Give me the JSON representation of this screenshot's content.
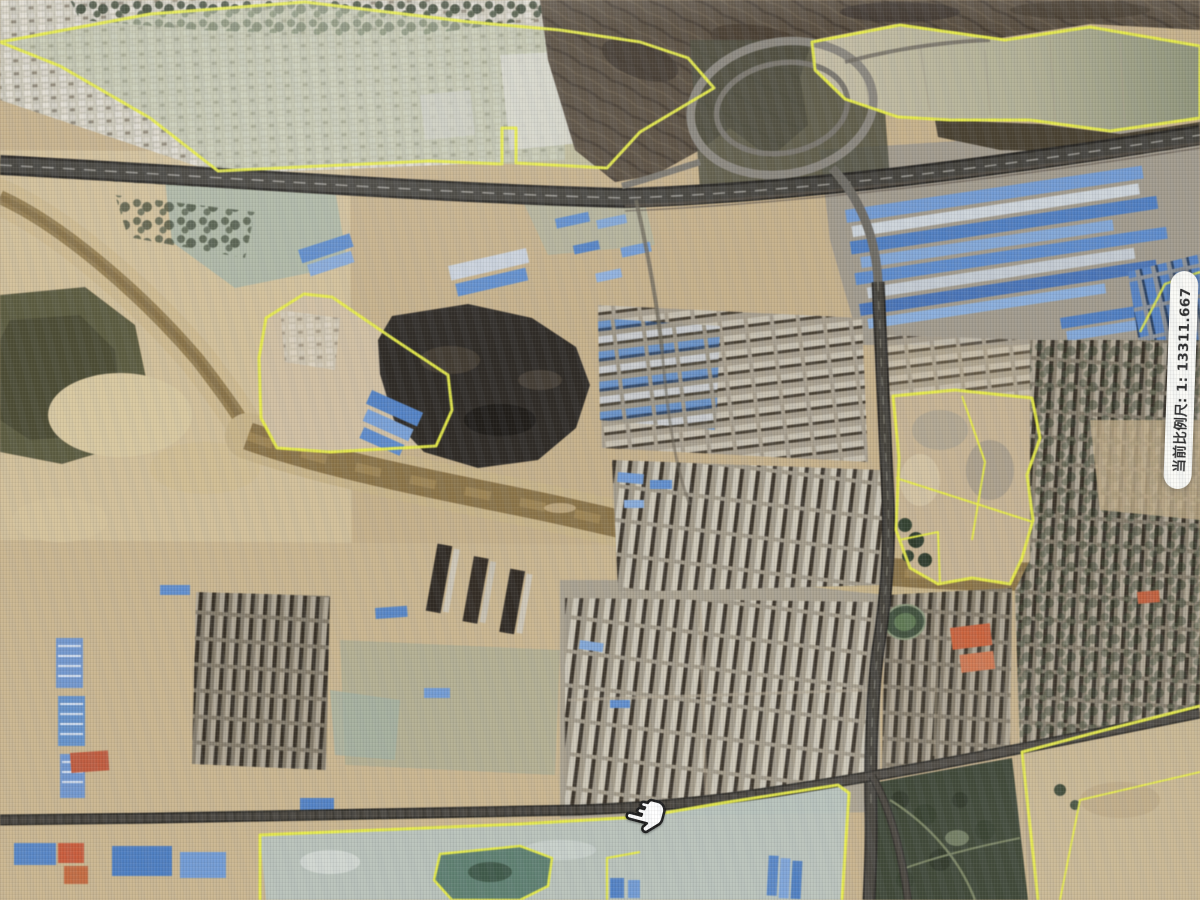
{
  "viewer": {
    "type": "satellite-map-viewer",
    "language": "zh-CN"
  },
  "scale_indicator": {
    "text": "当前比例尺: 1: 13311.667",
    "scale_value": "1:13311.667",
    "background_color": "#fafaf6",
    "text_color": "#2b2b2b"
  },
  "cursor": {
    "icon": "hand-grab-cursor",
    "x": 630,
    "y": 800
  },
  "map_overlay": {
    "parcel_boundary_color": "#e9ee3b"
  },
  "imagery_colors": {
    "bare_earth": "#c7b087",
    "river_water": "#8c7344",
    "highway_asphalt": "#44423c",
    "blue_roofs": "#5285cc",
    "mountain": "#584c3d",
    "coal_stockyard": "#2d2923",
    "vegetation": "#36412f",
    "pond_water": "#5d8070"
  }
}
